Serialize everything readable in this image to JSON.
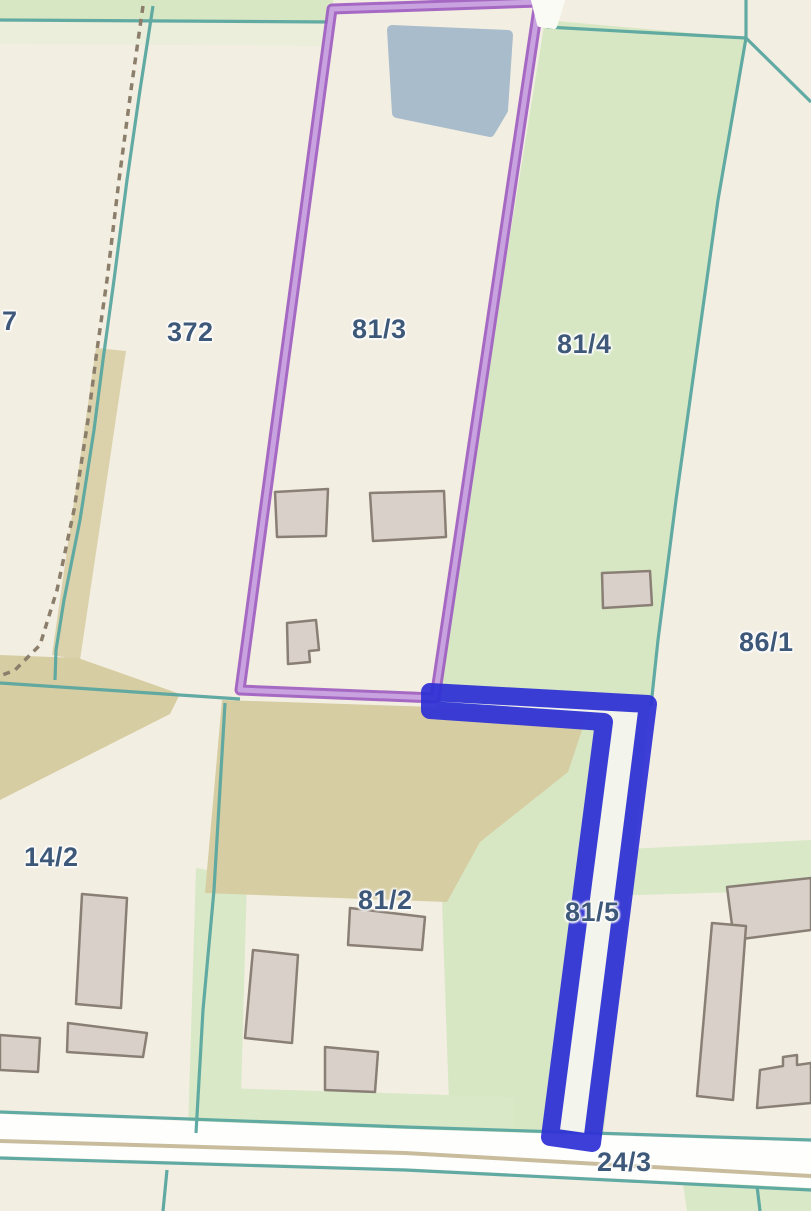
{
  "title": "Cadastral parcel map view",
  "map": {
    "labels": [
      {
        "id": "7",
        "text": "7"
      },
      {
        "id": "372",
        "text": "372"
      },
      {
        "id": "81-3",
        "text": "81/3"
      },
      {
        "id": "81-4",
        "text": "81/4"
      },
      {
        "id": "86-1",
        "text": "86/1"
      },
      {
        "id": "14-2",
        "text": "14/2"
      },
      {
        "id": "81-2",
        "text": "81/2"
      },
      {
        "id": "81-5",
        "text": "81/5"
      },
      {
        "id": "24-3",
        "text": "24/3"
      }
    ],
    "highlights": {
      "purple_outlined_parcel": "81/3",
      "blue_outlined_parcel": "81/5"
    },
    "colors": {
      "background_beige": "#f3eee2",
      "parcel_green": "#d7e7c4",
      "olive_field": "#d6cda2",
      "boundary_teal": "#5aa7a0",
      "highlight_purple": "#9c5ac1",
      "highlight_purple_light": "#c9a6e0",
      "highlight_blue": "#2f31d6",
      "building_fill": "#d9d0ca",
      "building_outline": "#8a7f75",
      "structure_gray_blue": "#a9bccb",
      "road_fill": "#fefefc",
      "road_center_tan": "#c8bc9c",
      "path_dashed_brown": "#8b7e6b",
      "label_text": "#3d5878"
    }
  }
}
